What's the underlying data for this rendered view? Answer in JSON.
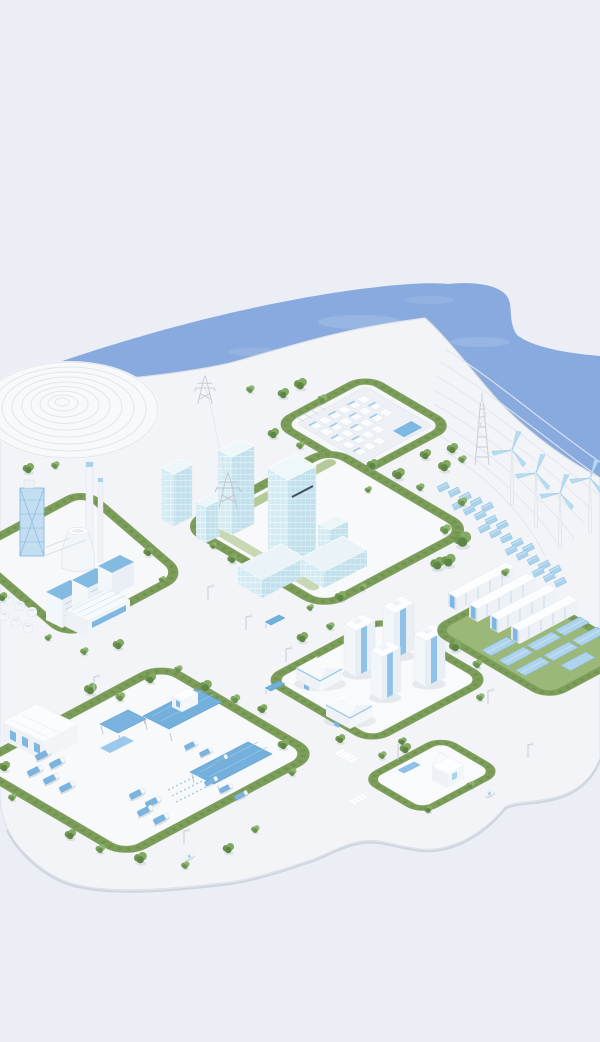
{
  "meta": {
    "description": "Isometric 3D miniature model of a coastal smart-energy city: white platform with seven hedged districts, blue water, wind turbines on terraced shore, solar farms and logistics depot",
    "visible_text": ""
  },
  "palette": {
    "background": "#ebeef4",
    "water": "#88aade",
    "water_highlight": "#ffffff",
    "water_edge": "#b7c0cf",
    "platform": "#f2f4f7",
    "platform_edge": "#dde2e9",
    "platform_shadow": "#c8cfd9",
    "district_ground": "#f7f9fb",
    "hedge": "#7d9e5b",
    "hedge_dark": "#6b8f4a",
    "lawn": "#9cb878",
    "foliage_dark": "#5d8544",
    "foliage_mid": "#6f9550",
    "foliage_light": "#83aa62",
    "building_white": "#f6f8fa",
    "building_shade": "#e8eef4",
    "accent_blue": "#7ab4df",
    "panel_blue": "#aed3ec",
    "glass_blue": "#d3eaf3",
    "structure_gray": "#c7ced8",
    "contour_gray": "#e3e8f0"
  },
  "scene": {
    "water": {
      "name": "sea",
      "shape": "organic swoosh band across upper third"
    },
    "terraced_mound": {
      "name": "contour-hill",
      "rings": 9
    },
    "coastal_hill": {
      "name": "terraced-shore",
      "wind_turbines": 4,
      "telecom_towers": 1,
      "blue_container_boxes": 23
    },
    "districts": [
      {
        "id": "substation",
        "name": "power-substation-plant",
        "equipment_rows": 5,
        "blue_control_building": 1
      },
      {
        "id": "industrial",
        "name": "industrial-plant",
        "chimneys": 2,
        "cooling_towers": 1,
        "blue_roof_buildings": 3,
        "storage_tanks": 6
      },
      {
        "id": "downtown",
        "name": "office-towers",
        "glass_towers": 5,
        "podium_blocks": 2
      },
      {
        "id": "residential",
        "name": "residential-quarter",
        "villas": 2,
        "apartment_towers": 4
      },
      {
        "id": "storage",
        "name": "battery-and-solar-farm",
        "battery_containers": 4,
        "solar_strips": 10
      },
      {
        "id": "logistics",
        "name": "truck-depot",
        "warehouses": 1,
        "solar_canopies": 3,
        "trucks": 15,
        "gatehouse": 1
      },
      {
        "id": "smallplot",
        "name": "charging-station-plot",
        "station_buildings": 1,
        "solar_panels": 1
      }
    ],
    "infrastructure": {
      "transmission_pylons": 2,
      "ghost_pylons": 4,
      "street_lamps": 7,
      "bus_shelters": 2,
      "white_cars": 2,
      "crosswalks": 2,
      "trees": 48
    }
  }
}
